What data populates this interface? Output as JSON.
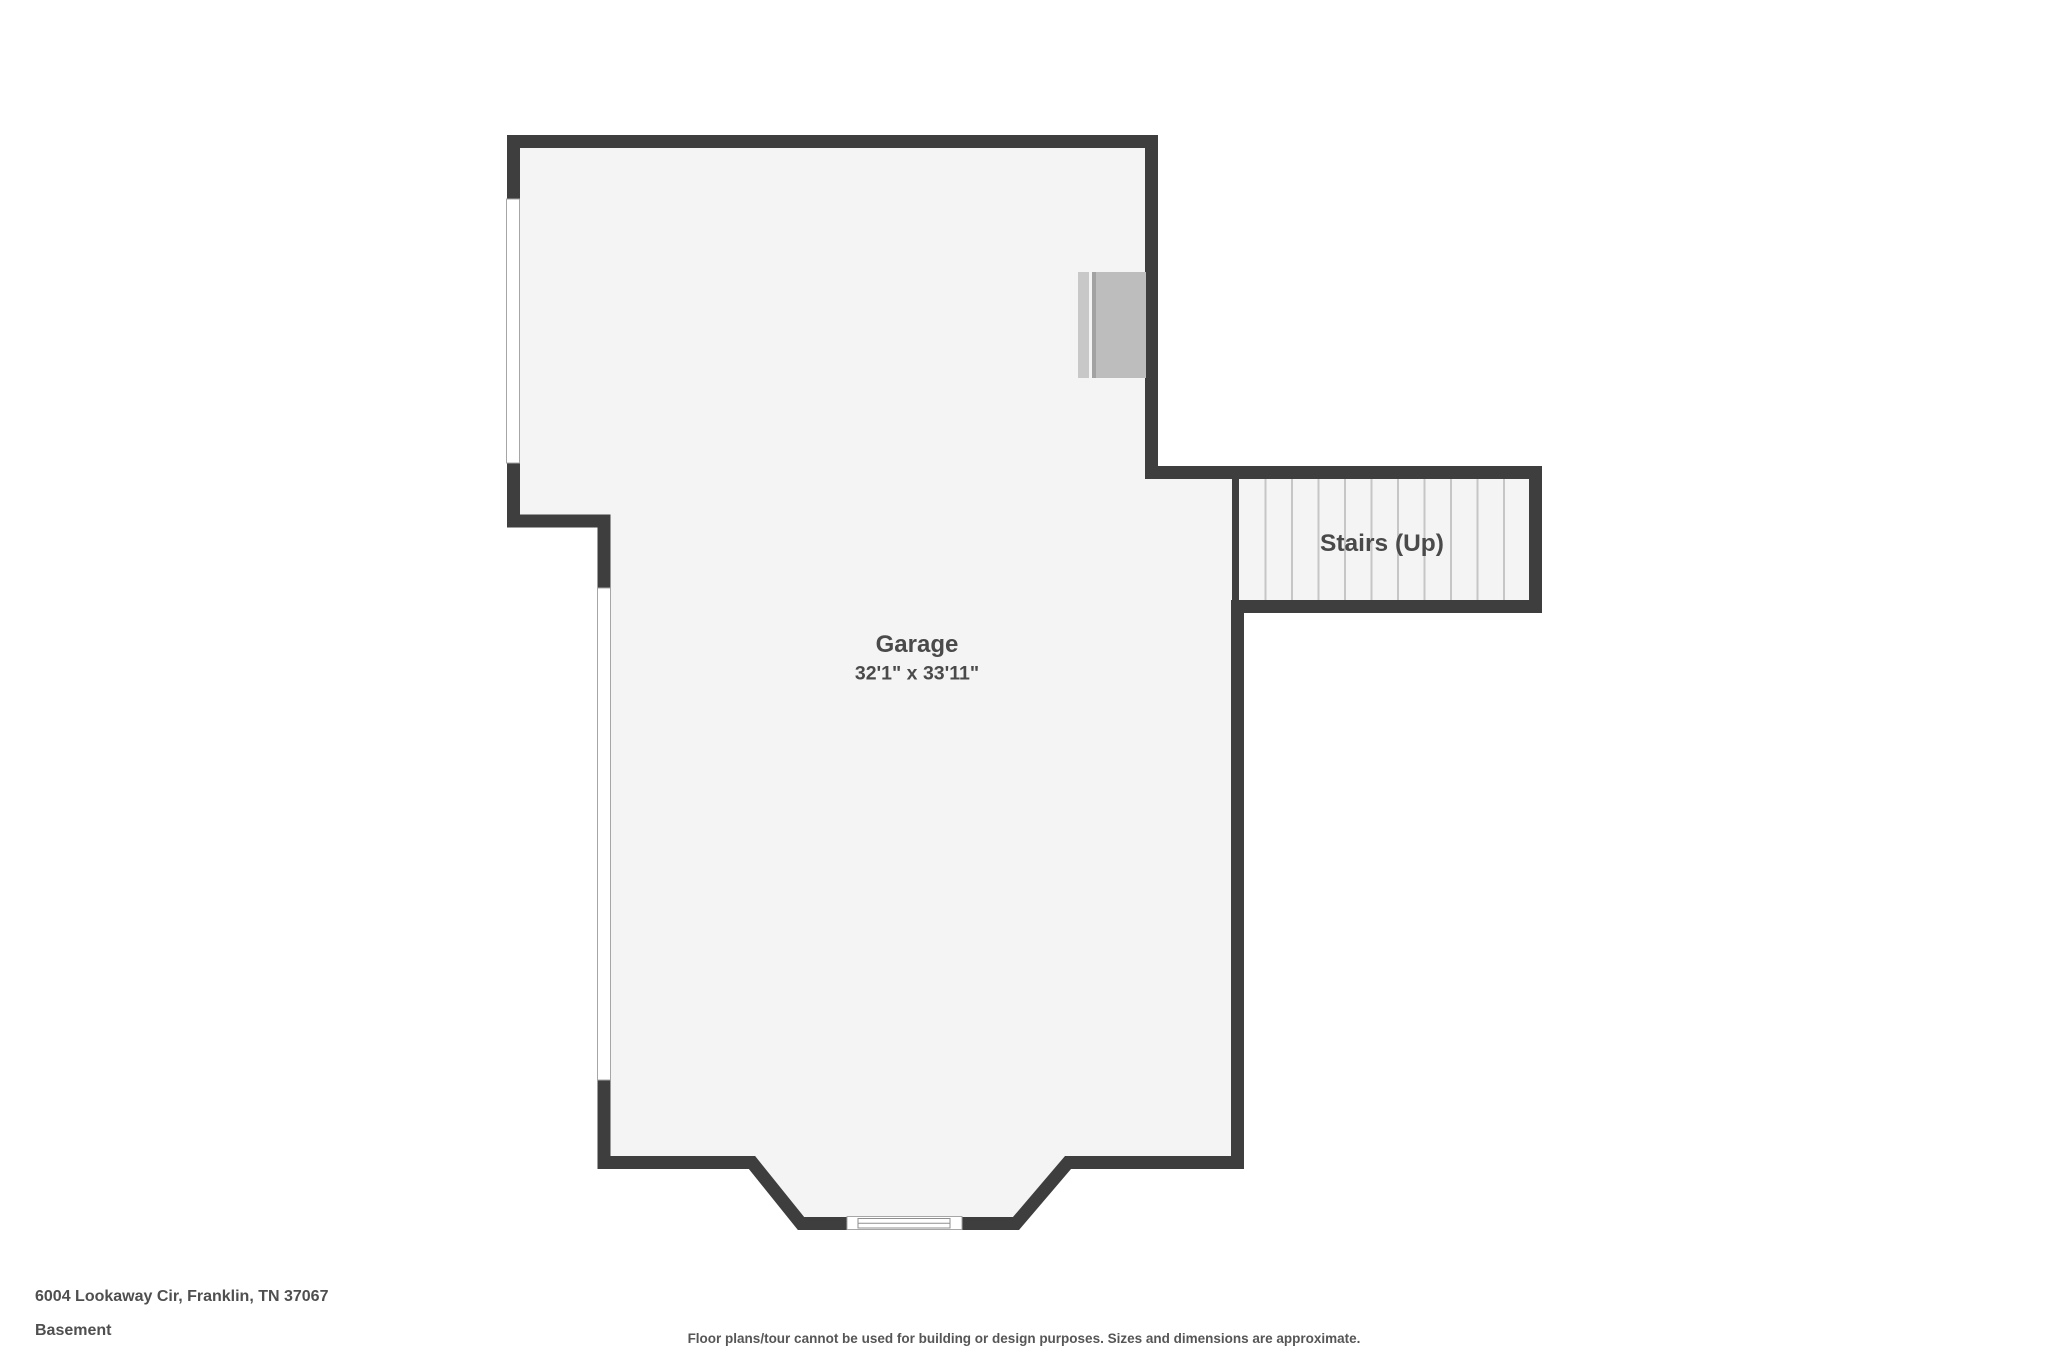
{
  "page": {
    "background_color": "#ffffff",
    "wall_color": "#3e3e3e",
    "floor_color": "#f4f4f4",
    "label_color": "#4a4a4a",
    "stair_tread_color": "#c6c6c6",
    "fixture_color": "#bdbdbd",
    "window_outline_color": "#a6a6a6"
  },
  "floor_plan": {
    "rooms": [
      {
        "name": "Garage",
        "dimensions": "32'1\" x 33'11\""
      },
      {
        "name": "Stairs (Up)",
        "dimensions": ""
      }
    ]
  },
  "footer": {
    "address": "6004 Lookaway Cir, Franklin, TN 37067",
    "level": "Basement",
    "disclaimer": "Floor plans/tour cannot be used for building or design purposes. Sizes and dimensions are approximate."
  }
}
